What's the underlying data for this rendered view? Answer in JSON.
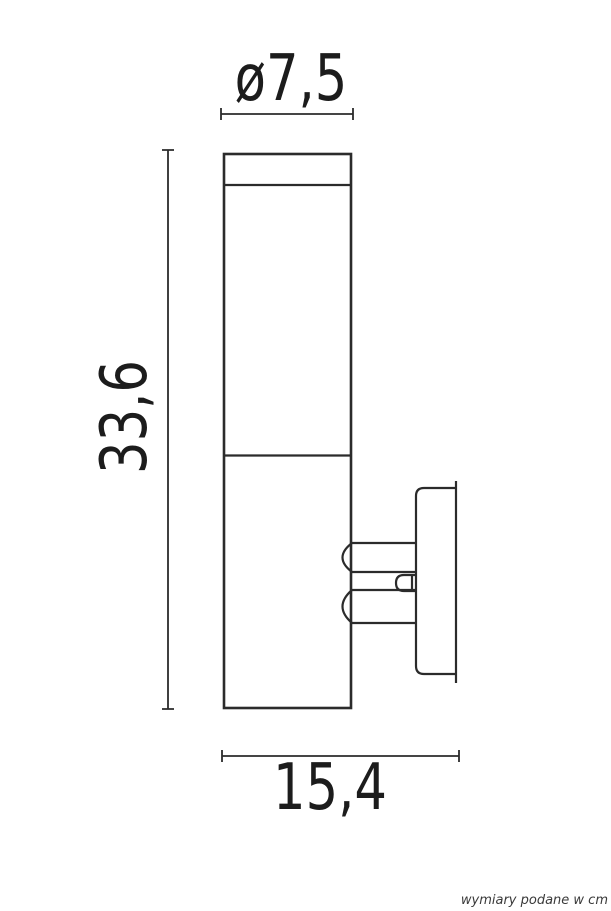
{
  "dimensions": {
    "diameter_label": "ø7,5",
    "height_label": "33,6",
    "depth_label": "15,4"
  },
  "footnote": {
    "text": "wymiary podane w cm"
  },
  "colors": {
    "line": "#2b2b2b",
    "text": "#1c1c1c",
    "footnote": "#3a3a3a",
    "bg": "#ffffff"
  }
}
